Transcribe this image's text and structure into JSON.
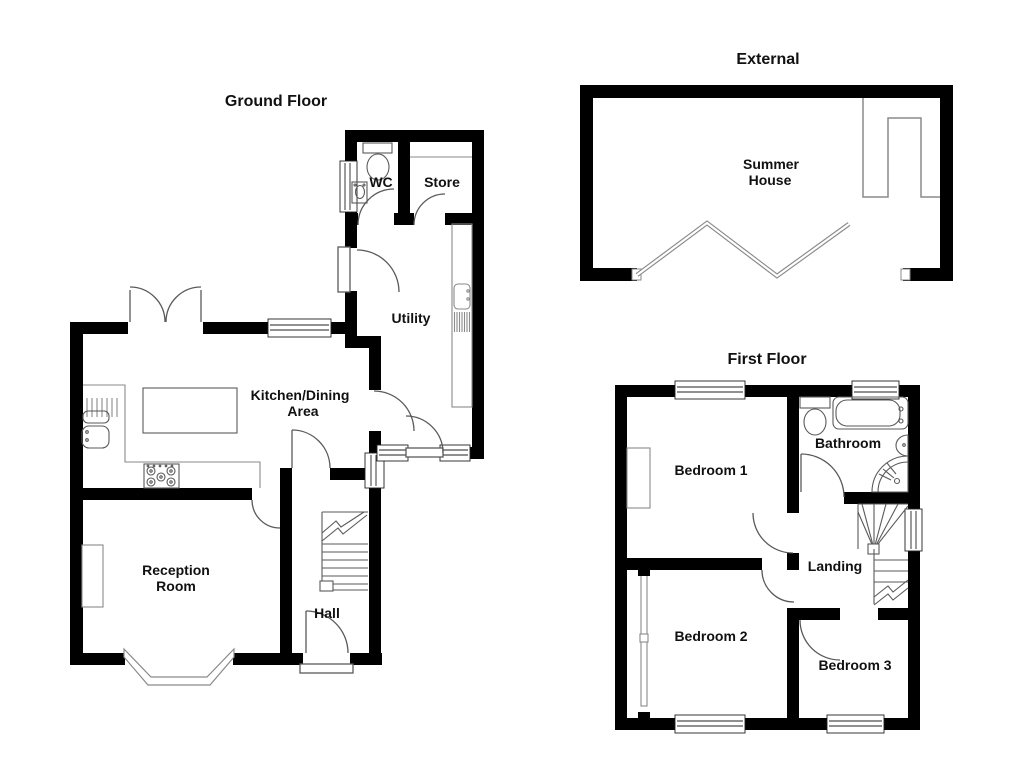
{
  "document": {
    "kind": "estate-agent floor plan",
    "background": "#ffffff"
  },
  "colors": {
    "wall": "#000000",
    "fixture_line": "#5a5a5a",
    "detail_line": "#8a8a8a",
    "window_line": "#222222",
    "text": "#111111"
  },
  "plans": {
    "ground": {
      "title": "Ground Floor",
      "labels": {
        "wc": "WC",
        "store": "Store",
        "utility": "Utility",
        "kitchen1": "Kitchen/Dining",
        "kitchen2": "Area",
        "reception1": "Reception",
        "reception2": "Room",
        "hall": "Hall"
      }
    },
    "external": {
      "title": "External",
      "labels": {
        "summer1": "Summer",
        "summer2": "House"
      }
    },
    "first": {
      "title": "First Floor",
      "labels": {
        "bedroom1": "Bedroom 1",
        "bathroom": "Bathroom",
        "landing": "Landing",
        "bedroom2": "Bedroom 2",
        "bedroom3": "Bedroom 3"
      }
    }
  },
  "icons": {
    "toilet": "toilet-icon",
    "sink": "sink-icon",
    "bath": "bath-icon",
    "shower": "shower-icon",
    "basin": "basin-icon",
    "hob": "hob-icon",
    "stairs": "stairs-icon",
    "window": "window-marker",
    "door": "door-swing"
  }
}
